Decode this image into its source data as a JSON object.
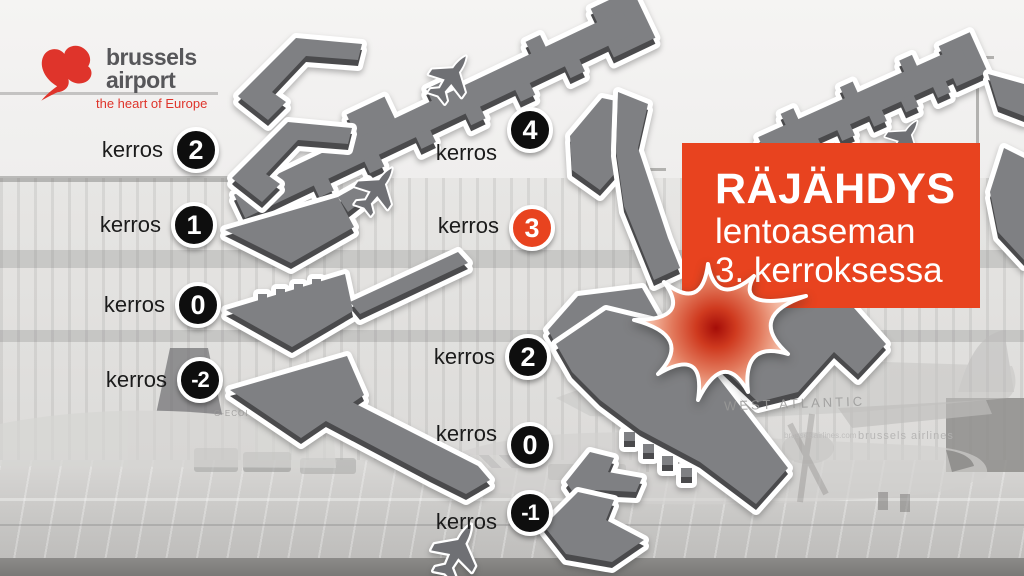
{
  "logo": {
    "line1": "brussels",
    "line2": "airport",
    "tagline": "the heart of Europe"
  },
  "floors": {
    "left": [
      {
        "label": "kerros",
        "number": "2"
      },
      {
        "label": "kerros",
        "number": "1"
      },
      {
        "label": "kerros",
        "number": "0"
      },
      {
        "label": "kerros",
        "number": "-2"
      }
    ],
    "right": [
      {
        "label": "kerros",
        "number": "4"
      },
      {
        "label": "kerros",
        "number": "3"
      },
      {
        "label": "kerros",
        "number": "2"
      },
      {
        "label": "kerros",
        "number": "0"
      },
      {
        "label": "kerros",
        "number": "-1"
      }
    ]
  },
  "callout": {
    "title": "RÄJÄHDYS",
    "line2": "lentoaseman",
    "line3": "3. kerroksessa"
  },
  "background_photo": {
    "west_atlantic": "WEST ATLANTIC",
    "brussels_airlines": "brussels airlines",
    "airline_url": "brusselsairlines.com",
    "registration": "G-ECOI"
  },
  "colors": {
    "accent_red": "#e8431f",
    "badge_black": "#0e0e0e",
    "shape_gray": "#7f8083",
    "shape_edge": "#4a4a4c",
    "logo_red": "#df342b",
    "logo_gray": "#57575a"
  }
}
